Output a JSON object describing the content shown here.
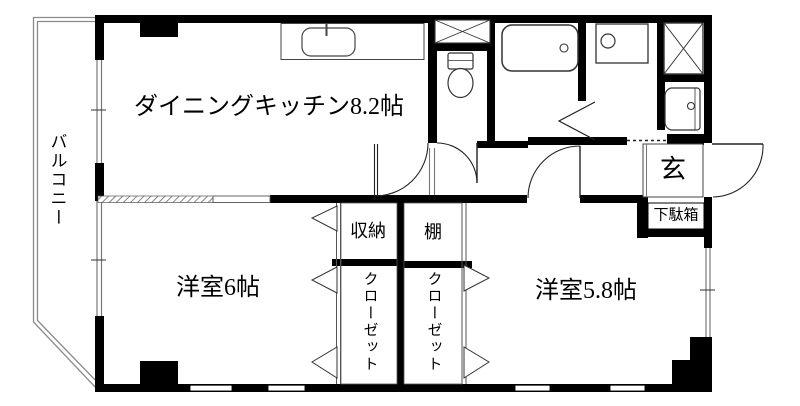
{
  "plan_title": "apartment-floor-plan",
  "colors": {
    "wall": "#000000",
    "background": "#ffffff",
    "thin_line": "#555555",
    "balcony_line": "#888888"
  },
  "rooms": {
    "balcony": {
      "label": "バルコニー"
    },
    "dining_kitchen": {
      "label": "ダイニングキッチン8.2帖"
    },
    "western_room_6": {
      "label": "洋室6帖"
    },
    "western_room_58": {
      "label": "洋室5.8帖"
    },
    "storage": {
      "label": "収納"
    },
    "shelf": {
      "label": "棚"
    },
    "closet_left": {
      "label": "クローゼット"
    },
    "closet_right": {
      "label": "クローゼット"
    },
    "entrance": {
      "label": "玄"
    },
    "shoe_cabinet": {
      "label": "下駄箱"
    }
  },
  "fixtures": [
    "kitchen-sink",
    "bathtub",
    "toilet",
    "washing-machine-pan",
    "wash-basin",
    "pipe-shaft-x2",
    "entrance-door",
    "room-doors",
    "bifold-closet-doors",
    "windows"
  ]
}
